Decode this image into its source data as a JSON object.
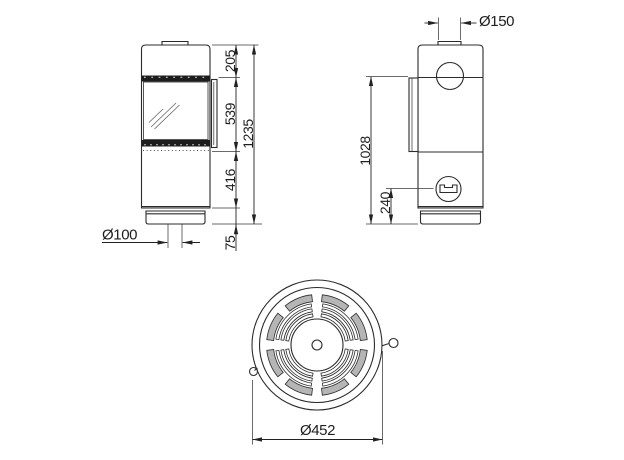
{
  "front_view": {
    "top_section_height": "205",
    "door_height": "539",
    "lower_section_height": "416",
    "plinth_height": "75",
    "total_height": "1235",
    "floor_air_inlet_diameter": "Ø100"
  },
  "side_view": {
    "flue_outlet_diameter": "Ø150",
    "rear_flue_center_height": "1028",
    "rear_air_inlet_center_height": "240"
  },
  "top_view": {
    "body_diameter": "Ø452"
  },
  "colors": {
    "background": "#ffffff",
    "line": "#222222",
    "vent_band": "#1c1c1c",
    "grille_slot_fill": "#b5b5b5"
  }
}
